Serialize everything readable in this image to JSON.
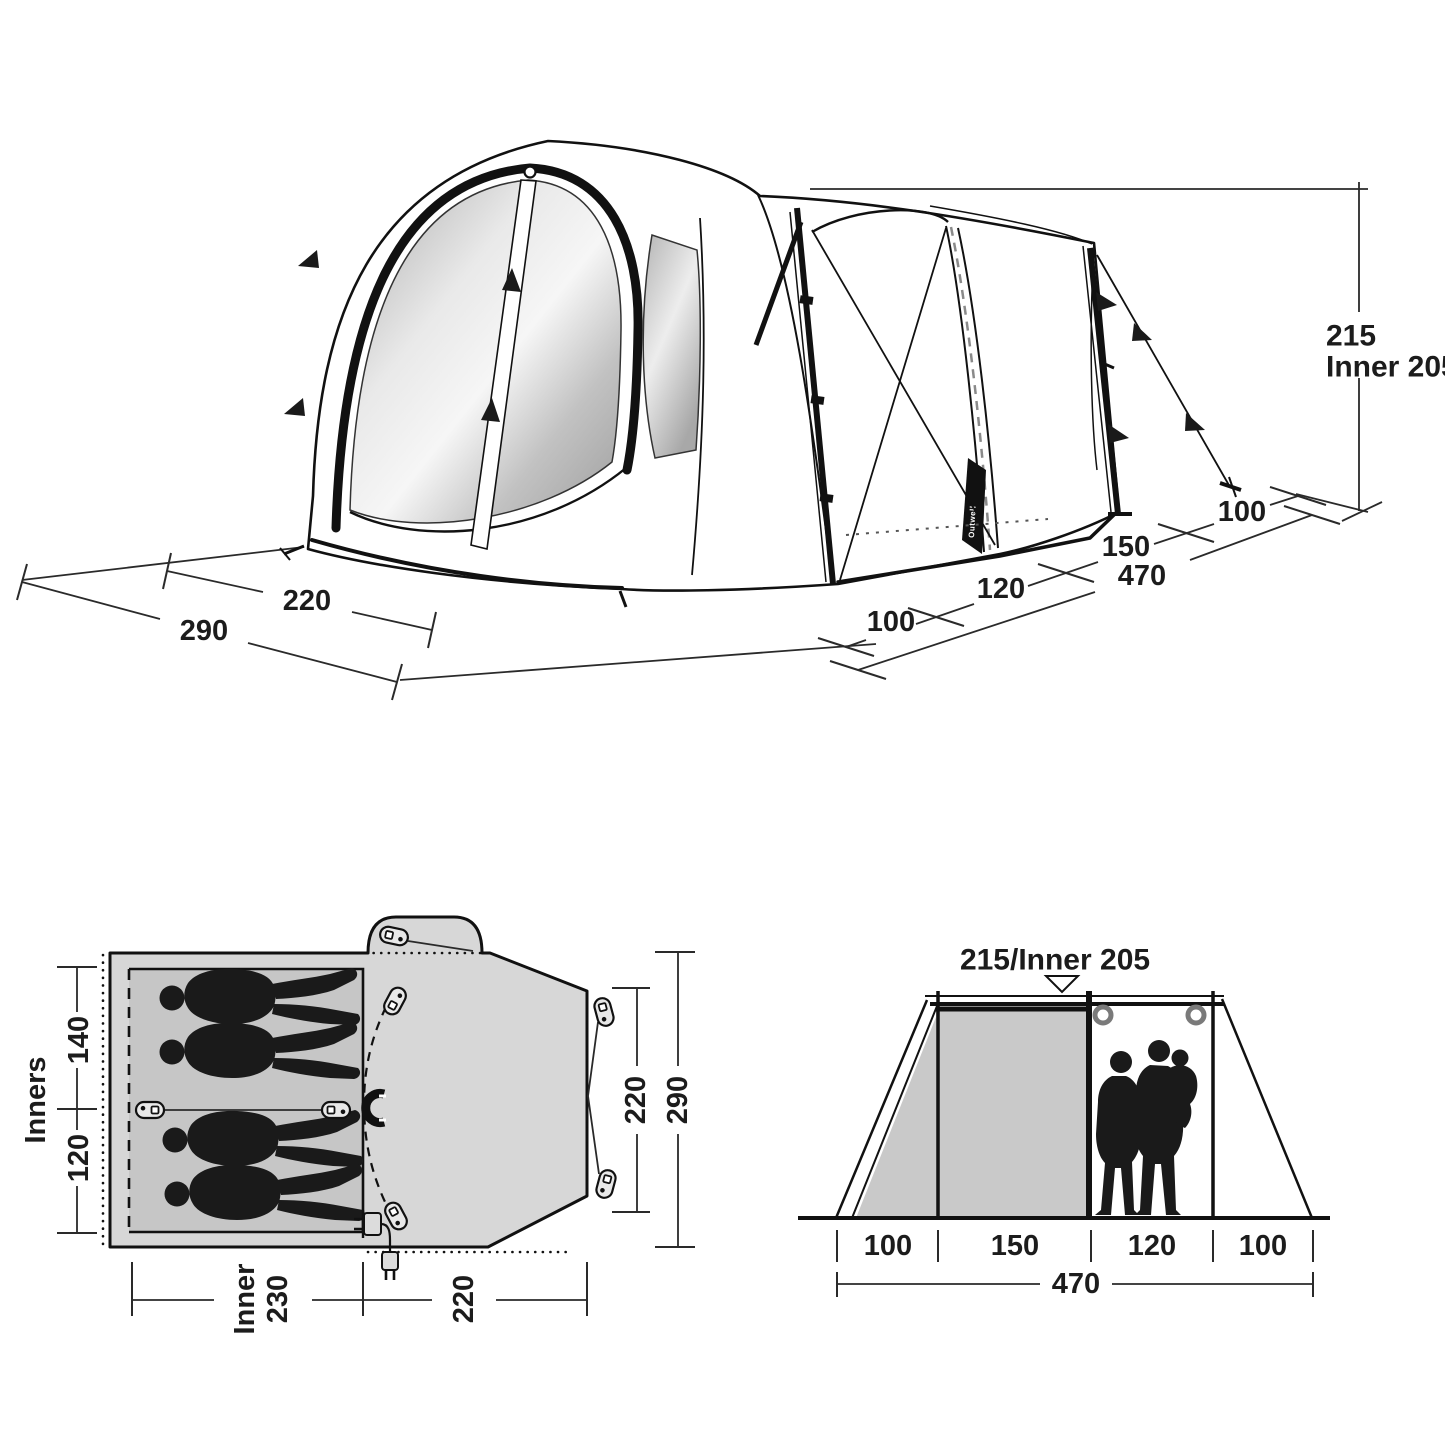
{
  "diagram": {
    "brand_tag": "Outwell",
    "perspective": {
      "height": "215",
      "inner_height": "Inner 205",
      "front_width_inner": "220",
      "front_width_total": "290",
      "seg_guy_front": "100",
      "seg_living": "120",
      "seg_mid": "150",
      "seg_guy_rear": "100",
      "side_total": "470"
    },
    "floor_plan": {
      "inners_label": "Inners",
      "inner_seg_top": "140",
      "inner_seg_bottom": "120",
      "bottom_inner_word": "Inner",
      "bottom_inner_value": "230",
      "bottom_porch": "220",
      "front_width_inner": "220",
      "front_width_total": "290"
    },
    "elevation": {
      "title": "215/Inner 205",
      "seg1": "100",
      "seg2": "150",
      "seg3": "120",
      "seg4": "100",
      "total": "470"
    }
  }
}
